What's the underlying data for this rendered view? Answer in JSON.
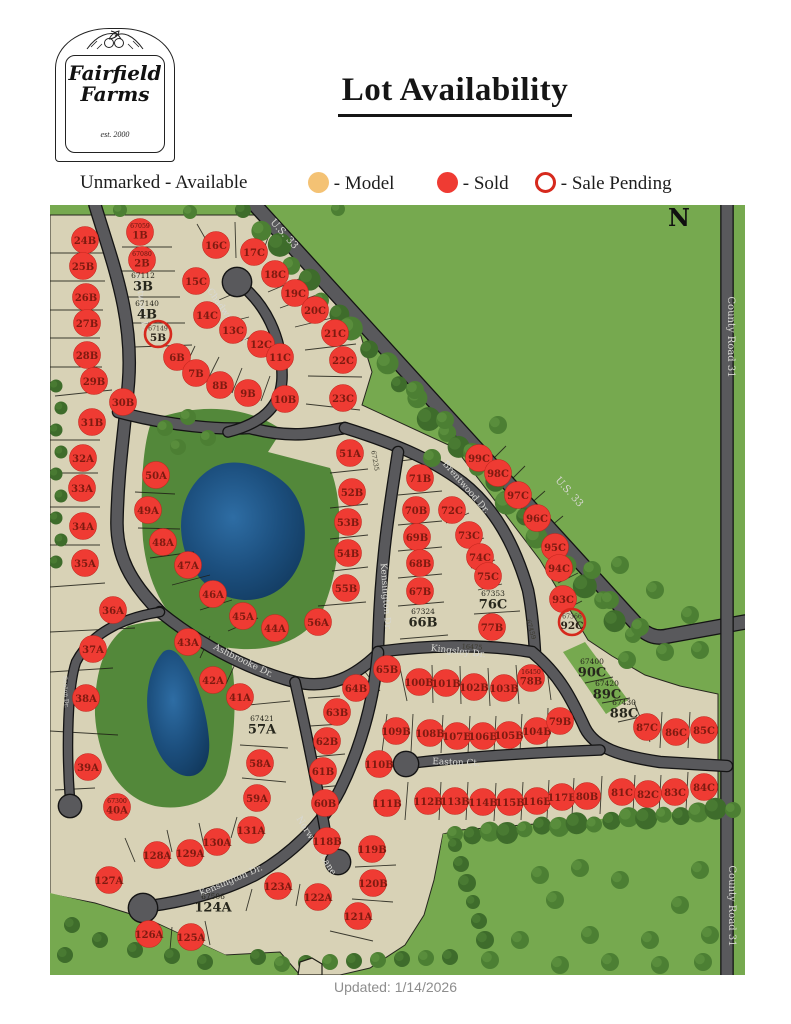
{
  "logo": {
    "line1": "Fairfield",
    "line2": "Farms",
    "est": "est. 2000"
  },
  "title": "Lot Availability",
  "legend": {
    "unmarked": "Unmarked - Available",
    "model": "- Model",
    "sold": "- Sold",
    "pending": "- Sale Pending"
  },
  "footer": "Updated: 1/14/2026",
  "colors": {
    "model_fill": "#f4c274",
    "sold_fill": "#ef3b33",
    "pending_ring": "#d6291d",
    "field_green": "#76a94f",
    "lot_beige": "#d8d2b6",
    "road_gray": "#59595c",
    "pond_blue": "#1c4f7e"
  },
  "map": {
    "compass": "N",
    "streets": [
      {
        "t": "Brentwood Dr.",
        "x": 139,
        "y": 302,
        "r": 83,
        "s": 9
      },
      {
        "t": "Chadwicke Ct.",
        "x": 226,
        "y": 318,
        "r": 55,
        "s": 9
      },
      {
        "t": "U.S. 33",
        "x": 282,
        "y": 236,
        "r": 48,
        "s": 10
      },
      {
        "t": "U.S. 33",
        "x": 567,
        "y": 494,
        "r": 48,
        "s": 10
      },
      {
        "t": "County Road 31",
        "x": 728,
        "y": 337,
        "r": 90,
        "s": 10
      },
      {
        "t": "County Road 31",
        "x": 729,
        "y": 906,
        "r": 90,
        "s": 10
      },
      {
        "t": "Brentwood Dr.",
        "x": 464,
        "y": 489,
        "r": 49,
        "s": 9
      },
      {
        "t": "Kensington Dr.",
        "x": 383,
        "y": 597,
        "r": 86,
        "s": 9
      },
      {
        "t": "Kingsley Dr.",
        "x": 458,
        "y": 654,
        "r": 7,
        "s": 9
      },
      {
        "t": "Ashbrooke Dr.",
        "x": 242,
        "y": 663,
        "r": 26,
        "s": 9
      },
      {
        "t": "Easton Ct.",
        "x": 456,
        "y": 765,
        "r": 2,
        "s": 9
      },
      {
        "t": "Norwood Lane",
        "x": 314,
        "y": 847,
        "r": 58,
        "s": 9
      },
      {
        "t": "Kensington Dr.",
        "x": 232,
        "y": 883,
        "r": -23,
        "s": 9
      },
      {
        "t": "Seaton Dr.",
        "x": 64,
        "y": 692,
        "r": 87,
        "s": 6
      }
    ],
    "annotations": [
      {
        "t": "67235",
        "x": 373,
        "y": 461,
        "r": 80
      },
      {
        "t": "16475",
        "x": 472,
        "y": 649,
        "r": 4
      },
      {
        "t": "67459",
        "x": 529,
        "y": 630,
        "r": 73
      }
    ],
    "lots": [
      {
        "id": "1B",
        "n": "67059",
        "x": 140,
        "y": 232,
        "st": "sold"
      },
      {
        "id": "2B",
        "n": "67080",
        "x": 142,
        "y": 260,
        "st": "sold"
      },
      {
        "id": "3B",
        "n": "67112",
        "x": 143,
        "y": 284,
        "st": "avail"
      },
      {
        "id": "4B",
        "n": "67140",
        "x": 147,
        "y": 312,
        "st": "avail"
      },
      {
        "id": "5B",
        "n": "67149",
        "x": 158,
        "y": 334,
        "st": "pending"
      },
      {
        "id": "6B",
        "x": 177,
        "y": 357,
        "st": "sold"
      },
      {
        "id": "7B",
        "x": 196,
        "y": 373,
        "st": "sold"
      },
      {
        "id": "8B",
        "x": 220,
        "y": 385,
        "st": "sold"
      },
      {
        "id": "9B",
        "x": 248,
        "y": 393,
        "st": "sold"
      },
      {
        "id": "10B",
        "x": 285,
        "y": 399,
        "st": "sold"
      },
      {
        "id": "24B",
        "x": 85,
        "y": 240,
        "st": "sold"
      },
      {
        "id": "25B",
        "x": 83,
        "y": 266,
        "st": "sold"
      },
      {
        "id": "26B",
        "x": 86,
        "y": 297,
        "st": "sold"
      },
      {
        "id": "27B",
        "x": 87,
        "y": 323,
        "st": "sold"
      },
      {
        "id": "28B",
        "x": 87,
        "y": 355,
        "st": "sold"
      },
      {
        "id": "29B",
        "x": 94,
        "y": 381,
        "st": "sold"
      },
      {
        "id": "30B",
        "x": 123,
        "y": 402,
        "st": "sold"
      },
      {
        "id": "31B",
        "x": 92,
        "y": 422,
        "st": "sold"
      },
      {
        "id": "15C",
        "x": 196,
        "y": 281,
        "st": "sold"
      },
      {
        "id": "16C",
        "x": 216,
        "y": 245,
        "st": "sold"
      },
      {
        "id": "17C",
        "x": 254,
        "y": 252,
        "st": "sold"
      },
      {
        "id": "18C",
        "x": 275,
        "y": 274,
        "st": "sold"
      },
      {
        "id": "19C",
        "x": 295,
        "y": 293,
        "st": "sold"
      },
      {
        "id": "20C",
        "x": 315,
        "y": 310,
        "st": "sold"
      },
      {
        "id": "14C",
        "x": 207,
        "y": 315,
        "st": "sold"
      },
      {
        "id": "13C",
        "x": 233,
        "y": 330,
        "st": "sold"
      },
      {
        "id": "12C",
        "x": 261,
        "y": 344,
        "st": "sold"
      },
      {
        "id": "11C",
        "x": 280,
        "y": 357,
        "st": "sold"
      },
      {
        "id": "21C",
        "x": 335,
        "y": 333,
        "st": "sold"
      },
      {
        "id": "22C",
        "x": 343,
        "y": 360,
        "st": "sold"
      },
      {
        "id": "23C",
        "x": 343,
        "y": 398,
        "st": "sold"
      },
      {
        "id": "32A",
        "x": 83,
        "y": 458,
        "st": "sold"
      },
      {
        "id": "33A",
        "x": 82,
        "y": 488,
        "st": "sold"
      },
      {
        "id": "34A",
        "x": 83,
        "y": 526,
        "st": "sold"
      },
      {
        "id": "35A",
        "x": 85,
        "y": 563,
        "st": "sold"
      },
      {
        "id": "36A",
        "x": 113,
        "y": 610,
        "st": "sold"
      },
      {
        "id": "50A",
        "x": 156,
        "y": 475,
        "st": "sold"
      },
      {
        "id": "49A",
        "x": 148,
        "y": 510,
        "st": "sold"
      },
      {
        "id": "48A",
        "x": 163,
        "y": 542,
        "st": "sold"
      },
      {
        "id": "47A",
        "x": 188,
        "y": 565,
        "st": "sold"
      },
      {
        "id": "46A",
        "x": 213,
        "y": 594,
        "st": "sold"
      },
      {
        "id": "45A",
        "x": 243,
        "y": 616,
        "st": "sold"
      },
      {
        "id": "44A",
        "x": 275,
        "y": 628,
        "st": "sold"
      },
      {
        "id": "43A",
        "x": 188,
        "y": 642,
        "st": "sold"
      },
      {
        "id": "37A",
        "x": 93,
        "y": 649,
        "st": "sold"
      },
      {
        "id": "38A",
        "x": 86,
        "y": 698,
        "st": "sold"
      },
      {
        "id": "39A",
        "x": 88,
        "y": 767,
        "st": "sold"
      },
      {
        "id": "40A",
        "n": "67300",
        "x": 117,
        "y": 807,
        "st": "sold"
      },
      {
        "id": "42A",
        "x": 213,
        "y": 680,
        "st": "sold"
      },
      {
        "id": "41A",
        "x": 240,
        "y": 697,
        "st": "sold"
      },
      {
        "id": "57A",
        "n": "67421",
        "x": 262,
        "y": 727,
        "st": "avail"
      },
      {
        "id": "58A",
        "x": 260,
        "y": 763,
        "st": "sold"
      },
      {
        "id": "59A",
        "x": 257,
        "y": 798,
        "st": "sold"
      },
      {
        "id": "51A",
        "x": 350,
        "y": 453,
        "st": "sold"
      },
      {
        "id": "52B",
        "x": 352,
        "y": 492,
        "st": "sold"
      },
      {
        "id": "53B",
        "x": 348,
        "y": 522,
        "st": "sold"
      },
      {
        "id": "54B",
        "x": 348,
        "y": 553,
        "st": "sold"
      },
      {
        "id": "55B",
        "x": 346,
        "y": 588,
        "st": "sold"
      },
      {
        "id": "56A",
        "x": 318,
        "y": 622,
        "st": "sold"
      },
      {
        "id": "71B",
        "x": 420,
        "y": 478,
        "st": "sold"
      },
      {
        "id": "70B",
        "x": 416,
        "y": 510,
        "st": "sold"
      },
      {
        "id": "69B",
        "x": 417,
        "y": 537,
        "st": "sold"
      },
      {
        "id": "68B",
        "x": 420,
        "y": 563,
        "st": "sold"
      },
      {
        "id": "67B",
        "x": 420,
        "y": 591,
        "st": "sold"
      },
      {
        "id": "66B",
        "n": "67324",
        "x": 423,
        "y": 620,
        "st": "avail"
      },
      {
        "id": "72C",
        "x": 452,
        "y": 510,
        "st": "sold"
      },
      {
        "id": "73C",
        "x": 469,
        "y": 535,
        "st": "sold"
      },
      {
        "id": "74C",
        "x": 480,
        "y": 557,
        "st": "sold"
      },
      {
        "id": "75C",
        "x": 488,
        "y": 576,
        "st": "sold"
      },
      {
        "id": "76C",
        "n": "67353",
        "x": 493,
        "y": 602,
        "st": "avail"
      },
      {
        "id": "77B",
        "x": 492,
        "y": 627,
        "st": "sold"
      },
      {
        "id": "99C",
        "x": 479,
        "y": 458,
        "st": "sold"
      },
      {
        "id": "98C",
        "x": 498,
        "y": 473,
        "st": "sold"
      },
      {
        "id": "97C",
        "x": 518,
        "y": 495,
        "st": "sold"
      },
      {
        "id": "96C",
        "x": 537,
        "y": 518,
        "st": "sold"
      },
      {
        "id": "95C",
        "x": 555,
        "y": 547,
        "st": "sold"
      },
      {
        "id": "94C",
        "x": 559,
        "y": 568,
        "st": "sold"
      },
      {
        "id": "93C",
        "x": 563,
        "y": 599,
        "st": "sold"
      },
      {
        "id": "92C",
        "n": "67366",
        "x": 572,
        "y": 622,
        "st": "pending"
      },
      {
        "id": "65B",
        "x": 387,
        "y": 669,
        "st": "sold"
      },
      {
        "id": "64B",
        "x": 356,
        "y": 688,
        "st": "sold"
      },
      {
        "id": "100B",
        "x": 419,
        "y": 682,
        "st": "sold"
      },
      {
        "id": "101B",
        "x": 446,
        "y": 683,
        "st": "sold"
      },
      {
        "id": "102B",
        "x": 474,
        "y": 687,
        "st": "sold"
      },
      {
        "id": "103B",
        "x": 504,
        "y": 688,
        "st": "sold"
      },
      {
        "id": "78B",
        "n": "16450",
        "x": 531,
        "y": 678,
        "st": "sold"
      },
      {
        "id": "109B",
        "x": 396,
        "y": 731,
        "st": "sold"
      },
      {
        "id": "108B",
        "x": 430,
        "y": 733,
        "st": "sold"
      },
      {
        "id": "107B",
        "x": 457,
        "y": 736,
        "st": "sold"
      },
      {
        "id": "106B",
        "x": 483,
        "y": 736,
        "st": "sold"
      },
      {
        "id": "105B",
        "x": 509,
        "y": 735,
        "st": "sold"
      },
      {
        "id": "104B",
        "x": 537,
        "y": 731,
        "st": "sold"
      },
      {
        "id": "79B",
        "x": 560,
        "y": 721,
        "st": "sold"
      },
      {
        "id": "110B",
        "x": 379,
        "y": 764,
        "st": "sold"
      },
      {
        "id": "111B",
        "x": 387,
        "y": 803,
        "st": "sold"
      },
      {
        "id": "112B",
        "x": 428,
        "y": 801,
        "st": "sold"
      },
      {
        "id": "113B",
        "x": 455,
        "y": 801,
        "st": "sold"
      },
      {
        "id": "114B",
        "x": 483,
        "y": 802,
        "st": "sold"
      },
      {
        "id": "115B",
        "x": 510,
        "y": 802,
        "st": "sold"
      },
      {
        "id": "116B",
        "x": 537,
        "y": 801,
        "st": "sold"
      },
      {
        "id": "117B",
        "x": 562,
        "y": 797,
        "st": "sold"
      },
      {
        "id": "80B",
        "x": 587,
        "y": 796,
        "st": "sold"
      },
      {
        "id": "90C",
        "n": "67400",
        "x": 592,
        "y": 670,
        "st": "avail"
      },
      {
        "id": "89C",
        "n": "67420",
        "x": 607,
        "y": 692,
        "st": "avail"
      },
      {
        "id": "88C",
        "n": "67430",
        "x": 624,
        "y": 711,
        "st": "avail"
      },
      {
        "id": "87C",
        "x": 647,
        "y": 727,
        "st": "sold"
      },
      {
        "id": "86C",
        "x": 676,
        "y": 732,
        "st": "sold"
      },
      {
        "id": "85C",
        "x": 704,
        "y": 730,
        "st": "sold"
      },
      {
        "id": "81C",
        "x": 622,
        "y": 792,
        "st": "sold"
      },
      {
        "id": "82C",
        "x": 648,
        "y": 794,
        "st": "sold"
      },
      {
        "id": "83C",
        "x": 675,
        "y": 792,
        "st": "sold"
      },
      {
        "id": "84C",
        "x": 704,
        "y": 787,
        "st": "sold"
      },
      {
        "id": "63B",
        "x": 337,
        "y": 712,
        "st": "sold"
      },
      {
        "id": "62B",
        "x": 327,
        "y": 741,
        "st": "sold"
      },
      {
        "id": "61B",
        "x": 323,
        "y": 771,
        "st": "sold"
      },
      {
        "id": "60B",
        "x": 325,
        "y": 803,
        "st": "sold"
      },
      {
        "id": "118B",
        "x": 327,
        "y": 841,
        "st": "sold"
      },
      {
        "id": "119B",
        "x": 372,
        "y": 849,
        "st": "sold"
      },
      {
        "id": "120B",
        "x": 373,
        "y": 883,
        "st": "sold"
      },
      {
        "id": "121A",
        "x": 358,
        "y": 916,
        "st": "sold"
      },
      {
        "id": "122A",
        "x": 318,
        "y": 897,
        "st": "sold"
      },
      {
        "id": "123A",
        "x": 278,
        "y": 886,
        "st": "sold"
      },
      {
        "id": "124A",
        "n": "67506",
        "x": 213,
        "y": 905,
        "st": "avail"
      },
      {
        "id": "125A",
        "x": 191,
        "y": 937,
        "st": "sold"
      },
      {
        "id": "126A",
        "x": 149,
        "y": 934,
        "st": "sold"
      },
      {
        "id": "127A",
        "x": 109,
        "y": 880,
        "st": "sold"
      },
      {
        "id": "128A",
        "x": 157,
        "y": 855,
        "st": "sold"
      },
      {
        "id": "129A",
        "x": 190,
        "y": 853,
        "st": "sold"
      },
      {
        "id": "130A",
        "x": 217,
        "y": 842,
        "st": "sold"
      },
      {
        "id": "131A",
        "x": 251,
        "y": 830,
        "st": "sold"
      }
    ]
  }
}
